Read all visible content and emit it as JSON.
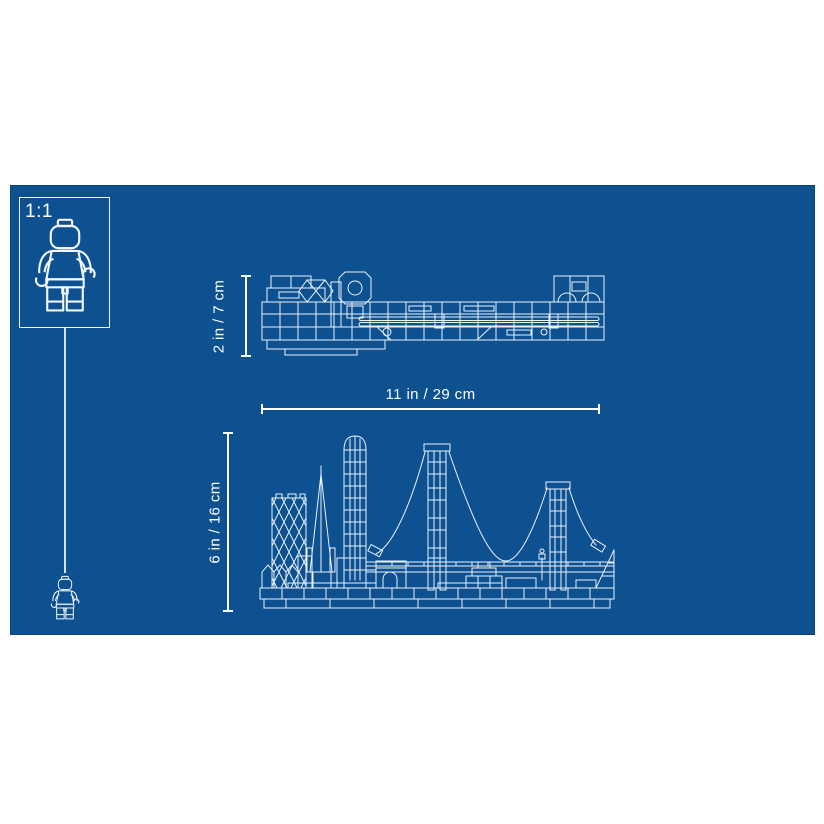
{
  "image": {
    "kind": "product-dimension-blueprint",
    "colors": {
      "page_background": "#ffffff",
      "blueprint_background": "#0d5191",
      "line_art": "#e9f1fa",
      "dimension_lines": "#ffffff"
    }
  },
  "scale_reference": {
    "ratio_label": "1:1",
    "figure_icon": "minifigure-icon",
    "actual_size_figure_icon": "minifigure-small-icon"
  },
  "dimensions": {
    "top_view_height": "2 in / 7 cm",
    "set_width": "11 in / 29 cm",
    "front_view_height": "6 in / 16 cm"
  }
}
